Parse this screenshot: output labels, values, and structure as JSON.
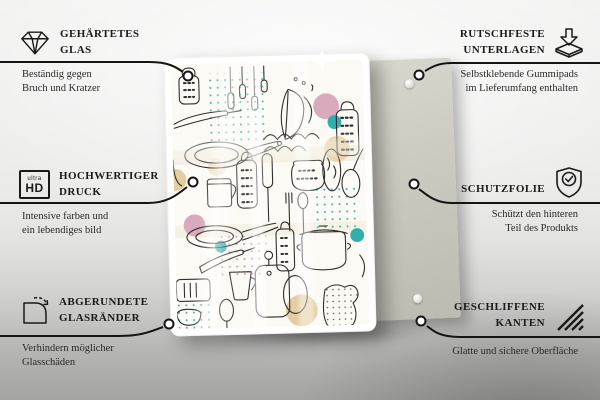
{
  "product": {
    "description": "Glass board with black line-art kitchen utensil doodle pattern and pastel accents, shown in front of a grey back panel with rubber pads",
    "colors": {
      "accent_teal": "#35b2ac",
      "accent_pink": "#d9aabb",
      "accent_beige": "#e4cda1",
      "back_panel": "#c7c7bd",
      "pattern_background": "#fcfaf4",
      "line_art": "#2d2d2d"
    }
  },
  "callouts": {
    "left": [
      {
        "icon": "diamond-icon",
        "title": [
          "GEHÄRTETES",
          "GLAS"
        ],
        "desc": [
          "Beständig gegen",
          "Bruch und Kratzer"
        ]
      },
      {
        "icon": "ultra-hd-icon",
        "icon_text_top": "ultra",
        "icon_text_main": "HD",
        "title": [
          "HOCHWERTIGER",
          "DRUCK"
        ],
        "desc": [
          "Intensive farben und",
          "ein lebendiges bild"
        ]
      },
      {
        "icon": "rounded-corner-arrow-icon",
        "title": [
          "ABGERUNDETE",
          "GLASRÄNDER"
        ],
        "desc": [
          "Verhindern möglicher",
          "Glasschäden"
        ]
      }
    ],
    "right": [
      {
        "icon": "arrow-into-pad-icon",
        "title": [
          "RUTSCHFESTE",
          "UNTERLAGEN"
        ],
        "desc": [
          "Selbstklebende Gummipads",
          "im Lieferumfang enthalten"
        ]
      },
      {
        "icon": "shield-check-icon",
        "title": [
          "SCHUTZFOLIE"
        ],
        "desc": [
          "Schützt den hinteren",
          "Teil des Produkts"
        ]
      },
      {
        "icon": "diagonal-hatch-icon",
        "title": [
          "GESCHLIFFENE",
          "KANTEN"
        ],
        "desc": [
          "Glatte und sichere Oberfläche"
        ]
      }
    ]
  }
}
